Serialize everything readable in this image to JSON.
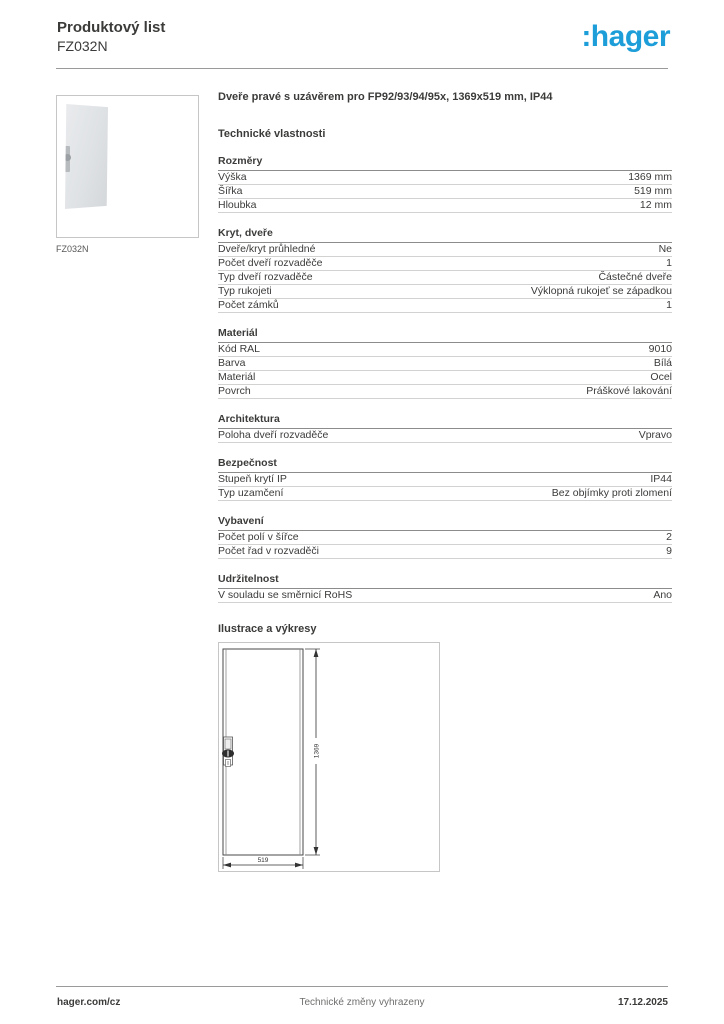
{
  "header": {
    "title": "Produktový list",
    "product_code": "FZ032N",
    "logo": ":hager",
    "logo_color": "#1d9ed9"
  },
  "product_image": {
    "caption": "FZ032N"
  },
  "product_title": "Dveře pravé s uzávěrem pro FP92/93/94/95x, 1369x519 mm, IP44",
  "tech_heading": "Technické vlastnosti",
  "sections": [
    {
      "title": "Rozměry",
      "rows": [
        {
          "label": "Výška",
          "value": "1369 mm"
        },
        {
          "label": "Šířka",
          "value": "519 mm"
        },
        {
          "label": "Hloubka",
          "value": "12 mm"
        }
      ]
    },
    {
      "title": "Kryt, dveře",
      "rows": [
        {
          "label": "Dveře/kryt průhledné",
          "value": "Ne"
        },
        {
          "label": "Počet dveří rozvaděče",
          "value": "1"
        },
        {
          "label": "Typ dveří rozvaděče",
          "value": "Částečné dveře"
        },
        {
          "label": "Typ rukojeti",
          "value": "Výklopná rukojeť se západkou"
        },
        {
          "label": "Počet zámků",
          "value": "1"
        }
      ]
    },
    {
      "title": "Materiál",
      "rows": [
        {
          "label": "Kód RAL",
          "value": "9010"
        },
        {
          "label": "Barva",
          "value": "Bílá"
        },
        {
          "label": "Materiál",
          "value": "Ocel"
        },
        {
          "label": "Povrch",
          "value": "Práškové lakování"
        }
      ]
    },
    {
      "title": "Architektura",
      "rows": [
        {
          "label": "Poloha dveří rozvaděče",
          "value": "Vpravo"
        }
      ]
    },
    {
      "title": "Bezpečnost",
      "rows": [
        {
          "label": "Stupeň krytí IP",
          "value": "IP44"
        },
        {
          "label": "Typ uzamčení",
          "value": "Bez objímky proti zlomení"
        }
      ]
    },
    {
      "title": "Vybavení",
      "rows": [
        {
          "label": "Počet polí v šířce",
          "value": "2"
        },
        {
          "label": "Počet řad v rozvaděči",
          "value": "9"
        }
      ]
    },
    {
      "title": "Udržitelnost",
      "rows": [
        {
          "label": "V souladu se směrnicí RoHS",
          "value": "Ano"
        }
      ]
    }
  ],
  "illustrations_heading": "Ilustrace a výkresy",
  "drawing": {
    "height_label": "1369",
    "width_label": "519"
  },
  "footer": {
    "left": "hager.com/cz",
    "center": "Technické změny vyhrazeny",
    "right": "17.12.2025"
  }
}
